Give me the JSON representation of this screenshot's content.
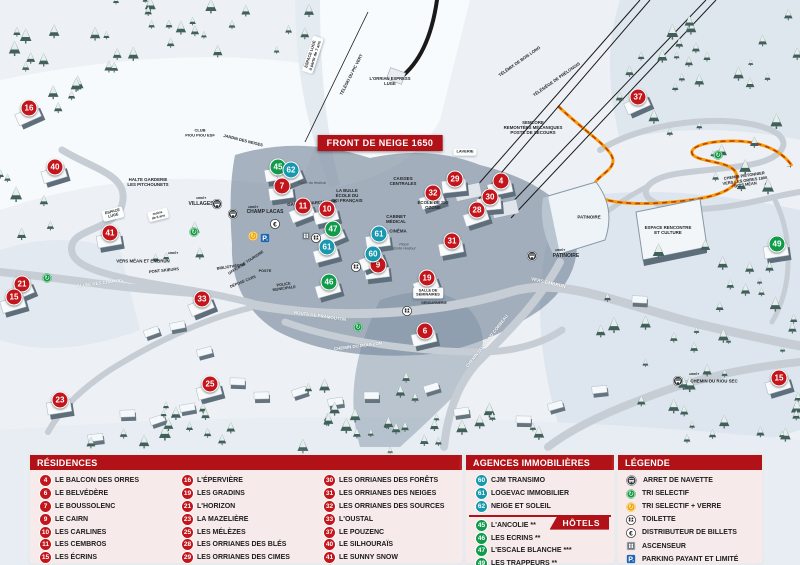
{
  "colors": {
    "residence": "#c3161c",
    "agency": "#1898ae",
    "hotel": "#0f9b4a",
    "header_red": "#b01218",
    "banner_red": "#c3161c",
    "path_orange": "#f59d00"
  },
  "map": {
    "banner": "FRONT DE NEIGE 1650",
    "markers": [
      {
        "num": "16",
        "type": "residence",
        "x": 29,
        "y": 108
      },
      {
        "num": "40",
        "type": "residence",
        "x": 55,
        "y": 167
      },
      {
        "num": "41",
        "type": "residence",
        "x": 110,
        "y": 233
      },
      {
        "num": "21",
        "type": "residence",
        "x": 22,
        "y": 284
      },
      {
        "num": "15",
        "type": "residence",
        "x": 14,
        "y": 297
      },
      {
        "num": "23",
        "type": "residence",
        "x": 60,
        "y": 400
      },
      {
        "num": "33",
        "type": "residence",
        "x": 202,
        "y": 299
      },
      {
        "num": "25",
        "type": "residence",
        "x": 210,
        "y": 384
      },
      {
        "num": "7",
        "type": "residence",
        "x": 282,
        "y": 186
      },
      {
        "num": "11",
        "type": "residence",
        "x": 303,
        "y": 206
      },
      {
        "num": "10",
        "type": "residence",
        "x": 327,
        "y": 209
      },
      {
        "num": "9",
        "type": "residence",
        "x": 378,
        "y": 265
      },
      {
        "num": "19",
        "type": "residence",
        "x": 427,
        "y": 278
      },
      {
        "num": "6",
        "type": "residence",
        "x": 425,
        "y": 331
      },
      {
        "num": "29",
        "type": "residence",
        "x": 455,
        "y": 179
      },
      {
        "num": "32",
        "type": "residence",
        "x": 433,
        "y": 193
      },
      {
        "num": "4",
        "type": "residence",
        "x": 501,
        "y": 181
      },
      {
        "num": "30",
        "type": "residence",
        "x": 490,
        "y": 197
      },
      {
        "num": "28",
        "type": "residence",
        "x": 477,
        "y": 210
      },
      {
        "num": "31",
        "type": "residence",
        "x": 452,
        "y": 241
      },
      {
        "num": "37",
        "type": "residence",
        "x": 638,
        "y": 97
      },
      {
        "num": "15",
        "type": "residence",
        "x": 779,
        "y": 378
      },
      {
        "num": "45",
        "type": "hotel",
        "x": 278,
        "y": 167
      },
      {
        "num": "47",
        "type": "hotel",
        "x": 333,
        "y": 229
      },
      {
        "num": "46",
        "type": "hotel",
        "x": 329,
        "y": 282
      },
      {
        "num": "49",
        "type": "hotel",
        "x": 777,
        "y": 244
      },
      {
        "num": "62",
        "type": "agency",
        "x": 291,
        "y": 170
      },
      {
        "num": "61",
        "type": "agency",
        "x": 327,
        "y": 247
      },
      {
        "num": "61",
        "type": "agency",
        "x": 379,
        "y": 234
      },
      {
        "num": "60",
        "type": "agency",
        "x": 373,
        "y": 254
      }
    ],
    "icons": [
      {
        "type": "bus-icon",
        "x": 217,
        "y": 204
      },
      {
        "type": "bus-icon",
        "x": 233,
        "y": 214
      },
      {
        "type": "bus-icon",
        "x": 532,
        "y": 256
      },
      {
        "type": "bus-icon",
        "x": 678,
        "y": 381
      },
      {
        "type": "recycle-icon",
        "x": 47,
        "y": 278
      },
      {
        "type": "recycle-icon",
        "x": 194,
        "y": 232
      },
      {
        "type": "recycle-icon",
        "x": 358,
        "y": 327
      },
      {
        "type": "recycle-icon",
        "x": 718,
        "y": 155
      },
      {
        "type": "recycle-glass-icon",
        "x": 253,
        "y": 236
      },
      {
        "type": "parking-icon",
        "x": 265,
        "y": 238
      },
      {
        "type": "euro-icon",
        "x": 275,
        "y": 224
      },
      {
        "type": "elevator-icon",
        "x": 306,
        "y": 236
      },
      {
        "type": "toilet-icon",
        "x": 316,
        "y": 238
      },
      {
        "type": "toilet-icon",
        "x": 356,
        "y": 267
      },
      {
        "type": "toilet-icon",
        "x": 407,
        "y": 311
      }
    ],
    "labels": [
      {
        "l": [
          "ESPACE LUGE",
          "à partir de 7 ans"
        ],
        "x": 313,
        "y": 55,
        "r": -72,
        "c": "pill",
        "f": 4
      },
      {
        "l": [
          "TÉLÉSKI DU PIC VERT"
        ],
        "x": 352,
        "y": 75,
        "r": -63,
        "f": 4.2
      },
      {
        "l": [
          "L'ORRIAN EXPRESS",
          "LUGE"
        ],
        "x": 390,
        "y": 82,
        "f": 4.2
      },
      {
        "l": [
          "TÉLÉMIX DE BOIS LONG"
        ],
        "x": 520,
        "y": 62,
        "r": -35,
        "f": 4.2
      },
      {
        "l": [
          "TÉLÉSIÈGE DE PRÉLONGIS"
        ],
        "x": 557,
        "y": 80,
        "r": -35,
        "f": 4.2
      },
      {
        "l": [
          "SEMLORE",
          "REMONTÉES MÉCANIQUES",
          "POSTE DE SECOURS"
        ],
        "x": 533,
        "y": 128,
        "f": 4.4
      },
      {
        "l": [
          "LAVERIE"
        ],
        "x": 465,
        "y": 152,
        "c": "pill",
        "f": 4
      },
      {
        "l": [
          "CAISSES",
          "CENTRALES"
        ],
        "x": 403,
        "y": 181,
        "f": 4.4
      },
      {
        "l": [
          "ÉCOLE DE SKI",
          "OZONE"
        ],
        "x": 433,
        "y": 205,
        "f": 4.4
      },
      {
        "l": [
          "CABINET",
          "MÉDICAL"
        ],
        "x": 396,
        "y": 219,
        "f": 4.4
      },
      {
        "l": [
          "CINÉMA"
        ],
        "x": 398,
        "y": 231,
        "f": 4.4
      },
      {
        "l": [
          "Place",
          "Émile Hodoul"
        ],
        "x": 404,
        "y": 247,
        "c": "it",
        "f": 3.8
      },
      {
        "l": [
          "LA BULLE",
          "ÉCOLE DU",
          "SKI FRANÇAIS"
        ],
        "x": 347,
        "y": 196,
        "f": 4.4
      },
      {
        "l": [
          "Place du festival"
        ],
        "x": 312,
        "y": 183,
        "c": "it",
        "f": 3.8
      },
      {
        "l": [
          "GALERIE MARCHANDE"
        ],
        "x": 312,
        "y": 203,
        "r": -4,
        "f": 4.4
      },
      {
        "l": [
          "ARRÊT"
        ],
        "x": 253,
        "y": 208,
        "f": 3
      },
      {
        "l": [
          "CHAMP LACAS"
        ],
        "x": 265,
        "y": 213,
        "f": 5
      },
      {
        "l": [
          "ARRÊT"
        ],
        "x": 201,
        "y": 199,
        "f": 3
      },
      {
        "l": [
          "VILLAGES"
        ],
        "x": 201,
        "y": 205,
        "f": 5
      },
      {
        "l": [
          "HALTE GARDERIE",
          "LES PITCHOUNETS"
        ],
        "x": 148,
        "y": 182,
        "f": 4.4
      },
      {
        "l": [
          "CLUB",
          "PIOU PIOU ESF"
        ],
        "x": 200,
        "y": 133,
        "f": 4
      },
      {
        "l": [
          "JARDIN DES NEIGES"
        ],
        "x": 243,
        "y": 141,
        "r": 14,
        "f": 4
      },
      {
        "l": [
          "ESPACE",
          "LUGE"
        ],
        "x": 113,
        "y": 214,
        "r": -14,
        "c": "pill",
        "f": 3.8
      },
      {
        "l": [
          "moins",
          "de 6 ans"
        ],
        "x": 158,
        "y": 215,
        "r": -14,
        "c": "pill",
        "f": 3.4
      },
      {
        "l": [
          "ARRÊT"
        ],
        "x": 173,
        "y": 254,
        "f": 3
      },
      {
        "l": [
          "VERS MÉAN ET EMBRUN"
        ],
        "x": 143,
        "y": 261,
        "f": 4.4
      },
      {
        "l": [
          "PONT SKIEURS"
        ],
        "x": 164,
        "y": 271,
        "r": -6,
        "f": 4
      },
      {
        "l": [
          "ALLÉE DES CHAMOIS"
        ],
        "x": 100,
        "y": 283,
        "r": -7,
        "c": "road",
        "f": 4.4
      },
      {
        "l": [
          "ROUTE DE PRAMOUTON"
        ],
        "x": 320,
        "y": 316,
        "r": 8,
        "c": "road",
        "f": 4.4
      },
      {
        "l": [
          "CHEMIN DU MOUFLON"
        ],
        "x": 358,
        "y": 346,
        "r": -7,
        "c": "road",
        "f": 4.4
      },
      {
        "l": [
          "CHEMIN DU GRAND CORBEAU"
        ],
        "x": 487,
        "y": 341,
        "r": -52,
        "c": "road",
        "f": 4.4
      },
      {
        "l": [
          "VERS EMBRUN"
        ],
        "x": 548,
        "y": 284,
        "r": 13,
        "c": "road",
        "f": 4.8
      },
      {
        "l": [
          "CHEMIN PIÉTONNIER",
          "VERS LES ORRES 1800",
          "BOIS MÉAN"
        ],
        "x": 745,
        "y": 181,
        "r": -8,
        "f": 4
      },
      {
        "l": [
          "→"
        ],
        "x": 789,
        "y": 167,
        "f": 7
      },
      {
        "l": [
          "PATINOIRE"
        ],
        "x": 589,
        "y": 217,
        "f": 4.4
      },
      {
        "l": [
          "ESPACE RENCONTRE",
          "ET CULTURE"
        ],
        "x": 668,
        "y": 230,
        "f": 4.4
      },
      {
        "l": [
          "ARRÊT"
        ],
        "x": 560,
        "y": 251,
        "f": 3
      },
      {
        "l": [
          "PATINOIRE"
        ],
        "x": 566,
        "y": 257,
        "f": 5
      },
      {
        "l": [
          "ARRÊT"
        ],
        "x": 694,
        "y": 375,
        "f": 3
      },
      {
        "l": [
          "CHEMIN DU RIOU SEC"
        ],
        "x": 714,
        "y": 381,
        "f": 4.4
      },
      {
        "l": [
          "OFFICE DE TOURISME"
        ],
        "x": 246,
        "y": 263,
        "r": -33,
        "f": 3.8
      },
      {
        "l": [
          "BIBLIOTHÈQUE"
        ],
        "x": 231,
        "y": 267,
        "r": -8,
        "f": 3.8
      },
      {
        "l": [
          "POSTE"
        ],
        "x": 265,
        "y": 271,
        "f": 3.8
      },
      {
        "l": [
          "DÉPOSE CARS"
        ],
        "x": 243,
        "y": 282,
        "r": -22,
        "f": 3.8
      },
      {
        "l": [
          "POLICE",
          "MUNICIPALE"
        ],
        "x": 284,
        "y": 287,
        "r": -8,
        "f": 3.8
      },
      {
        "l": [
          "SALLE DE",
          "SÉMINAIRES"
        ],
        "x": 428,
        "y": 293,
        "c": "pill",
        "f": 3.8
      },
      {
        "l": [
          "GENDARMERIE"
        ],
        "x": 434,
        "y": 303,
        "f": 3.4
      }
    ]
  },
  "panels": {
    "residences": {
      "title": "RÉSIDENCES",
      "columns": [
        [
          {
            "num": "4",
            "label": "LE BALCON DES ORRES"
          },
          {
            "num": "6",
            "label": "LE BELVÉDÈRE"
          },
          {
            "num": "7",
            "label": "LE BOUSSOLENC"
          },
          {
            "num": "9",
            "label": "LE CAIRN"
          },
          {
            "num": "10",
            "label": "LES CARLINES"
          },
          {
            "num": "11",
            "label": "LES CEMBROS"
          },
          {
            "num": "15",
            "label": "LES ÉCRINS"
          }
        ],
        [
          {
            "num": "16",
            "label": "L'ÉPERVIÈRE"
          },
          {
            "num": "19",
            "label": "LES GRADINS"
          },
          {
            "num": "21",
            "label": "L'HORIZON"
          },
          {
            "num": "23",
            "label": "LA MAZELIÈRE"
          },
          {
            "num": "25",
            "label": "LES MÉLÈZES"
          },
          {
            "num": "28",
            "label": "LES ORRIANES DES BLÉS"
          },
          {
            "num": "29",
            "label": "LES ORRIANES DES CIMES"
          }
        ],
        [
          {
            "num": "30",
            "label": "LES ORRIANES DES FORÊTS"
          },
          {
            "num": "31",
            "label": "LES ORRIANES DES NEIGES"
          },
          {
            "num": "32",
            "label": "LES ORRIANES DES SOURCES"
          },
          {
            "num": "33",
            "label": "L'OUSTAL"
          },
          {
            "num": "37",
            "label": "LE POUZENC"
          },
          {
            "num": "40",
            "label": "LE SILHOURAÏS"
          },
          {
            "num": "41",
            "label": "LE SUNNY SNOW"
          }
        ]
      ]
    },
    "agences": {
      "title": "AGENCES IMMOBILIÈRES",
      "items": [
        {
          "num": "60",
          "label": "CJM TRANSIMO"
        },
        {
          "num": "61",
          "label": "LOGEVAC IMMOBILIER"
        },
        {
          "num": "62",
          "label": "NEIGE ET SOLEIL"
        }
      ]
    },
    "hotels": {
      "title": "HÔTELS",
      "items": [
        {
          "num": "45",
          "label": "L'ANCOLIE **"
        },
        {
          "num": "46",
          "label": "LES ECRINS **"
        },
        {
          "num": "47",
          "label": "L'ESCALE BLANCHE ***"
        },
        {
          "num": "49",
          "label": "LES TRAPPEURS **"
        }
      ]
    },
    "legende": {
      "title": "LÉGENDE",
      "items": [
        {
          "icon": "bus-icon",
          "label": "ARRET DE NAVETTE"
        },
        {
          "icon": "recycle-icon",
          "label": "TRI SELECTIF"
        },
        {
          "icon": "recycle-glass-icon",
          "label": "TRI SELECTIF + VERRE"
        },
        {
          "icon": "toilet-icon",
          "label": "TOILETTE"
        },
        {
          "icon": "euro-icon",
          "label": "DISTRIBUTEUR DE BILLETS"
        },
        {
          "icon": "elevator-icon",
          "label": "ASCENSEUR"
        },
        {
          "icon": "parking-icon",
          "label": "PARKING PAYANT ET LIMITÉ"
        }
      ]
    }
  }
}
